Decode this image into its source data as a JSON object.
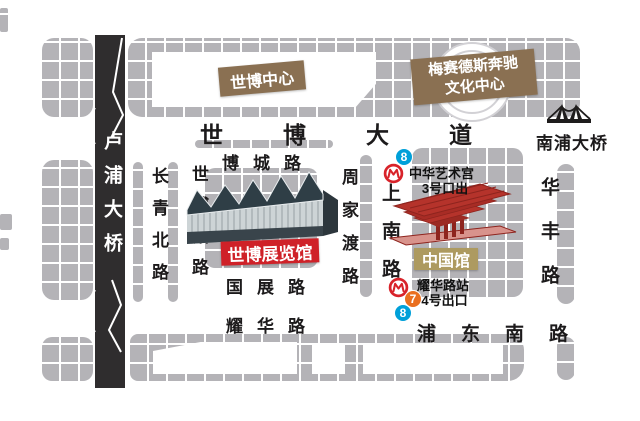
{
  "landmarks": {
    "expo_center": "世博中心",
    "mercedes_line1": "梅赛德斯奔驰",
    "mercedes_line2": "文化中心",
    "expo_hall": "世博展览馆",
    "china_pavilion": "中国馆",
    "nanpu_bridge": "南浦大桥",
    "lupu_bridge": "卢浦大桥"
  },
  "roads": {
    "expo_avenue": "世博大道",
    "bocheng": "博城路",
    "guozhan": "国展路",
    "yaohua": "耀华路",
    "pudong_south": "浦东南路",
    "changqing_north": "长青北路",
    "shibo_guan": "世博馆路",
    "zhoujiadu": "周家渡路",
    "shangnan": "上南路",
    "huafeng": "华丰路"
  },
  "metro": {
    "line8_badge": "8",
    "line7_badge": "7",
    "art_museum_line1": "中华艺术宫",
    "art_museum_line2": "3号口出",
    "yaohua_station_line1": "耀华路站",
    "yaohua_station_line2": "4号出口"
  },
  "colors": {
    "block": "#b4b3b7",
    "road_black": "#2f2d2e",
    "label_brown": "#8a7052",
    "label_red": "#cf2128",
    "label_tan": "#ad9a60",
    "line8_blue": "#00a0d9",
    "line7_orange": "#ea6f1f",
    "metro_logo_red": "#d8232a"
  }
}
